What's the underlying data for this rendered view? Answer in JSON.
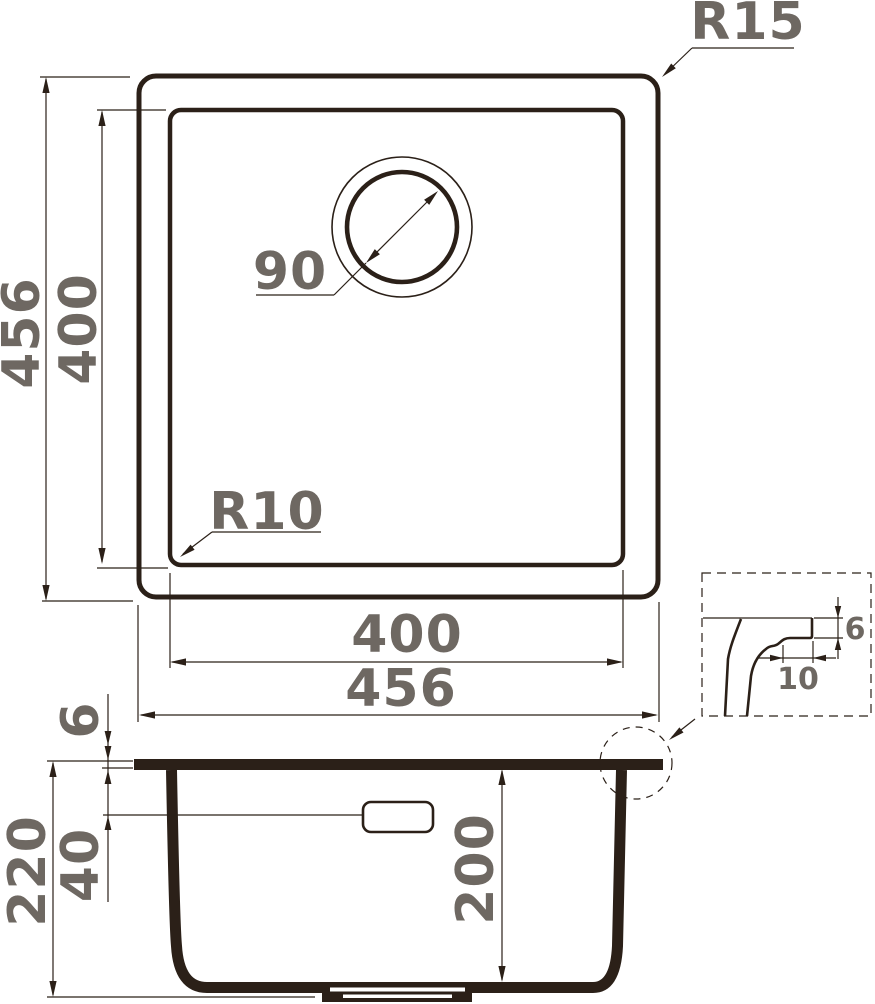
{
  "drawing_type": "sink technical drawing",
  "colors": {
    "line": "#2b2018",
    "dim_text": "#6e6862",
    "background": "#ffffff"
  },
  "labels": {
    "top_view": {
      "outer_size_vertical": "456",
      "inner_size_vertical": "400",
      "inner_size_horizontal": "400",
      "outer_size_horizontal": "456",
      "drain_diameter": "90",
      "outer_corner_radius": "R15",
      "inner_corner_radius": "R10"
    },
    "section_view": {
      "overall_depth": "220",
      "inner_depth": "200",
      "overflow_offset": "40",
      "rim_thickness": "6"
    },
    "detail_view": {
      "edge_height": "6",
      "edge_depth": "10"
    }
  }
}
